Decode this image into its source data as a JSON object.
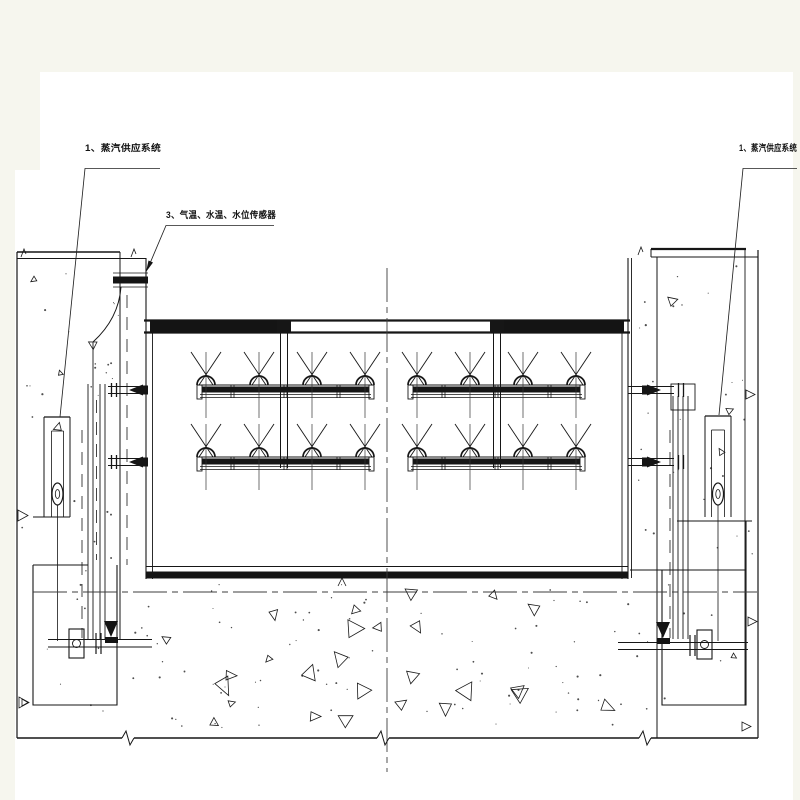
{
  "labels": {
    "steam_system_left": "1、蒸汽供应系统",
    "sensors": "3、气温、水温、水位传感器",
    "steam_system_right": "1、蒸汽供应系统"
  },
  "colors": {
    "background": "#f6f6ee",
    "paper": "#ffffff",
    "line": "#161616",
    "centerline": "#3d3d3d"
  }
}
